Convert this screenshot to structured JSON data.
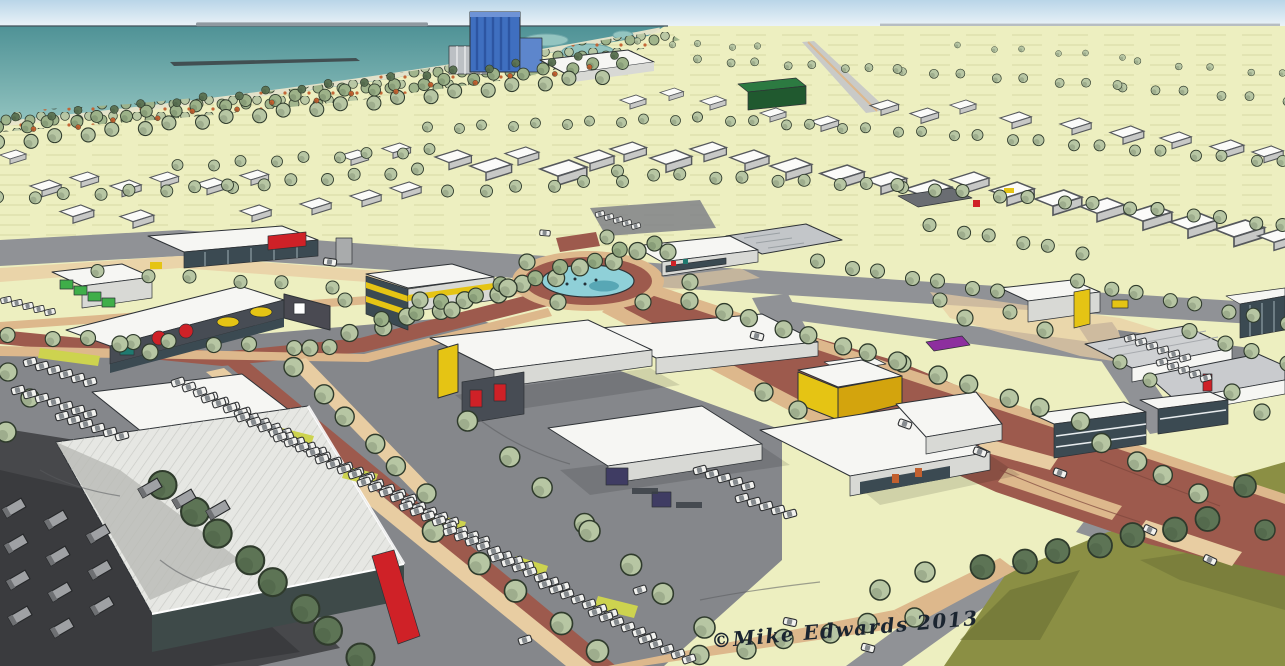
{
  "image": {
    "alt": "Hand-drawn aerial perspective illustration of a coastal retail and business park, with sea and a blue harbour tower at top left, tree-lined fields behind, white retail sheds with coloured shop signs, tree-lined avenues, car parks full of white cars, a pond roundabout, and an olive green hill at bottom right."
  },
  "signature": {
    "text": "©Mike Edwards 2013"
  },
  "palette": {
    "sky-top": "#b9d5e8",
    "sky-bottom": "#eef5f9",
    "sea-deep": "#4f9296",
    "sea-light": "#93c4c0",
    "beach": "#e9e5cb",
    "field": "#edefc0",
    "field-line": "#d7daa5",
    "tree-light": "#b7c6a3",
    "tree-mid": "#9db289",
    "tree-dark": "#5d7455",
    "tree-line": "#2f3b2c",
    "shrub-orange": "#c2602f",
    "road": "#909296",
    "road-dark": "#6f7175",
    "lot": "#85878b",
    "yard-dark": "#47484b",
    "yard-shadow": "#3a3b3e",
    "tan": "#ddb88c",
    "tan-light": "#e8cda2",
    "plaza-red": "#9d5a4d",
    "pond": "#8fd0d8",
    "pond-deep": "#58a7b5",
    "olive": "#8b8f44",
    "olive-dark": "#6b7034",
    "bldg-white": "#f6f6f3",
    "bldg-shade": "#d8d9d5",
    "bldg-side": "#a9abac",
    "glaze": "#3b4a52",
    "ink": "#2e3236",
    "fascia-dark": "#474c54",
    "sign-red": "#cf2127",
    "sign-yellow": "#e5c414",
    "sign-green": "#3fae49",
    "sign-teal": "#1f7a70",
    "sign-purple": "#8d2f9e",
    "sign-navy": "#3f3c63",
    "tower-blue": "#3f6fc0",
    "tower-blue-dark": "#2d55a2",
    "silo": "#bcc0c4",
    "green-box": "#20592f",
    "verge": "#cdd34f",
    "car-body": "#f2f2ef",
    "roof-rib": "#c6c7c3",
    "warehouse-teal": "#3e4a49"
  },
  "scene": {
    "tree_rows": [
      [
        0,
        128,
        620,
        62,
        26,
        6,
        "tree-mid"
      ],
      [
        0,
        143,
        600,
        76,
        22,
        7,
        "tree-light"
      ],
      [
        18,
        118,
        612,
        54,
        20,
        4,
        "tree-dark"
      ],
      [
        36,
        130,
        592,
        68,
        15,
        2.6,
        "shrub-orange"
      ],
      [
        430,
        128,
        700,
        118,
        11,
        5,
        "tree-light"
      ],
      [
        700,
        118,
        980,
        136,
        11,
        5,
        "tree-light"
      ],
      [
        980,
        136,
        1285,
        162,
        11,
        5.5,
        "tree-light"
      ],
      [
        180,
        166,
        432,
        150,
        9,
        5.5,
        "tree-light"
      ],
      [
        0,
        198,
        230,
        186,
        8,
        6,
        "tree-light"
      ],
      [
        230,
        186,
        420,
        170,
        7,
        6,
        "tree-light"
      ],
      [
        620,
        172,
        900,
        186,
        10,
        6,
        "tree-light"
      ],
      [
        900,
        186,
        1160,
        210,
        9,
        6.5,
        "tree-light"
      ],
      [
        1160,
        210,
        1285,
        226,
        5,
        6.5,
        "tree-light"
      ],
      [
        450,
        192,
        620,
        180,
        6,
        6,
        "tree-light"
      ],
      [
        700,
        60,
        900,
        70,
        8,
        4,
        "tree-light"
      ],
      [
        900,
        70,
        1120,
        86,
        8,
        4.5,
        "tree-light"
      ],
      [
        1120,
        86,
        1285,
        100,
        6,
        4.5,
        "tree-light"
      ],
      [
        640,
        42,
        760,
        47,
        5,
        3.2,
        "tree-light"
      ],
      [
        960,
        46,
        1120,
        56,
        6,
        3,
        "tree-light"
      ],
      [
        1140,
        62,
        1285,
        74,
        5,
        3.4,
        "tree-light"
      ],
      [
        352,
        334,
        640,
        252,
        11,
        8.5,
        "tree-light"
      ],
      [
        384,
        320,
        652,
        242,
        10,
        7.5,
        "tree-mid"
      ],
      [
        10,
        336,
        332,
        348,
        9,
        7.5,
        "tree-light"
      ],
      [
        692,
        302,
        900,
        362,
        8,
        8.5,
        "tree-light"
      ],
      [
        900,
        362,
        1078,
        420,
        6,
        9,
        "tree-light"
      ],
      [
        820,
        262,
        1000,
        292,
        7,
        7,
        "tree-light"
      ],
      [
        1080,
        282,
        1285,
        322,
        8,
        7,
        "tree-light"
      ],
      [
        1192,
        332,
        1285,
        362,
        4,
        7.5,
        "tree-light"
      ],
      [
        932,
        226,
        1080,
        252,
        6,
        6.5,
        "tree-light"
      ],
      [
        296,
        368,
        424,
        492,
        6,
        9.5,
        "tree-light"
      ],
      [
        470,
        422,
        582,
        522,
        4,
        10,
        "tree-light"
      ],
      [
        592,
        532,
        702,
        626,
        4,
        10.5,
        "tree-light"
      ],
      [
        702,
        656,
        912,
        616,
        6,
        9.5,
        "tree-light"
      ],
      [
        985,
        568,
        1210,
        520,
        7,
        12,
        "tree-dark"
      ],
      [
        165,
        486,
        358,
        656,
        8,
        14,
        "tree-dark"
      ],
      [
        100,
        272,
        330,
        286,
        6,
        6.5,
        "tree-light"
      ],
      [
        436,
        532,
        600,
        652,
        5,
        11,
        "tree-light"
      ],
      [
        1104,
        444,
        1196,
        492,
        4,
        9.5,
        "tree-light"
      ]
    ],
    "trees": [
      [
        527,
        262,
        8
      ],
      [
        558,
        302,
        8
      ],
      [
        643,
        302,
        8
      ],
      [
        668,
        252,
        8
      ],
      [
        607,
        237,
        7
      ],
      [
        508,
        288,
        9
      ],
      [
        690,
        282,
        8
      ],
      [
        8,
        372,
        9
      ],
      [
        30,
        398,
        9
      ],
      [
        6,
        432,
        10
      ],
      [
        150,
        352,
        8
      ],
      [
        120,
        344,
        8
      ],
      [
        1045,
        330,
        8
      ],
      [
        1010,
        312,
        7
      ],
      [
        965,
        318,
        8
      ],
      [
        940,
        300,
        7
      ],
      [
        1232,
        392,
        8
      ],
      [
        1262,
        412,
        8
      ],
      [
        1245,
        486,
        11,
        "tree-dark"
      ],
      [
        1265,
        530,
        10,
        "tree-dark"
      ],
      [
        880,
        590,
        10
      ],
      [
        925,
        572,
        10
      ],
      [
        420,
        300,
        8
      ],
      [
        452,
        310,
        8
      ],
      [
        764,
        392,
        9
      ],
      [
        798,
        410,
        9
      ],
      [
        1120,
        362,
        7
      ],
      [
        1150,
        380,
        7
      ],
      [
        345,
        300,
        7
      ],
      [
        310,
        348,
        8
      ]
    ],
    "car_rows": [
      [
        178,
        382,
        11,
        5,
        7,
        -18
      ],
      [
        208,
        398,
        11,
        5,
        8,
        -18
      ],
      [
        243,
        417,
        11,
        5,
        8,
        -18
      ],
      [
        280,
        437,
        11,
        5,
        9,
        -18
      ],
      [
        322,
        459,
        11,
        5,
        9,
        -18
      ],
      [
        364,
        482,
        11,
        5,
        9,
        -18
      ],
      [
        406,
        506,
        11,
        5,
        8,
        -18
      ],
      [
        450,
        531,
        11,
        5,
        8,
        -18
      ],
      [
        497,
        557,
        11,
        5,
        7,
        -18
      ],
      [
        545,
        584,
        11,
        5,
        7,
        -18
      ],
      [
        595,
        612,
        11,
        5,
        6,
        -18
      ],
      [
        645,
        639,
        11,
        5,
        5,
        -18
      ],
      [
        30,
        362,
        12,
        4,
        6,
        -15
      ],
      [
        18,
        390,
        12,
        4,
        7,
        -15
      ],
      [
        62,
        416,
        12,
        4,
        6,
        -15
      ],
      [
        700,
        470,
        12,
        4,
        5,
        -15
      ],
      [
        742,
        498,
        12,
        4,
        5,
        -15
      ],
      [
        600,
        214,
        9,
        3,
        5,
        -15,
        0.7
      ],
      [
        1130,
        338,
        11,
        4,
        6,
        -15,
        0.85
      ],
      [
        1162,
        362,
        11,
        4,
        5,
        -15,
        0.85
      ],
      [
        6,
        300,
        11,
        3,
        5,
        -12,
        0.8
      ]
    ],
    "cars": [
      [
        757,
        336,
        15
      ],
      [
        905,
        424,
        20
      ],
      [
        1060,
        473,
        20
      ],
      [
        1150,
        530,
        25
      ],
      [
        980,
        452,
        20
      ],
      [
        640,
        590,
        -18
      ],
      [
        790,
        622,
        12
      ],
      [
        525,
        640,
        -18
      ],
      [
        330,
        262,
        8
      ],
      [
        545,
        233,
        5,
        0.8
      ],
      [
        1210,
        560,
        25
      ],
      [
        868,
        648,
        15
      ]
    ],
    "trailer_rows": [
      [
        14,
        508,
        2,
        36,
        4,
        -30
      ],
      [
        56,
        520,
        2,
        36,
        4,
        -30
      ],
      [
        98,
        534,
        2,
        36,
        3,
        -30
      ],
      [
        150,
        488,
        34,
        11,
        3,
        -30
      ]
    ],
    "sheds": [
      [
        435,
        150,
        1.4
      ],
      [
        470,
        158,
        1.6
      ],
      [
        505,
        147,
        1.3
      ],
      [
        540,
        160,
        1.8
      ],
      [
        575,
        150,
        1.5
      ],
      [
        610,
        142,
        1.4
      ],
      [
        650,
        150,
        1.6
      ],
      [
        690,
        142,
        1.4
      ],
      [
        730,
        150,
        1.5
      ],
      [
        770,
        158,
        1.6
      ],
      [
        820,
        165,
        1.7
      ],
      [
        865,
        172,
        1.6
      ],
      [
        905,
        180,
        1.8
      ],
      [
        950,
        172,
        1.5
      ],
      [
        990,
        182,
        1.7
      ],
      [
        1035,
        190,
        1.8
      ],
      [
        1080,
        198,
        1.7
      ],
      [
        1125,
        205,
        1.8
      ],
      [
        1170,
        213,
        1.8
      ],
      [
        1215,
        220,
        1.9
      ],
      [
        1258,
        228,
        1.6
      ],
      [
        620,
        95,
        1.0
      ],
      [
        660,
        88,
        0.9
      ],
      [
        700,
        96,
        1.0
      ],
      [
        760,
        108,
        1.0
      ],
      [
        810,
        116,
        1.1
      ],
      [
        870,
        100,
        1.1
      ],
      [
        910,
        108,
        1.1
      ],
      [
        950,
        100,
        1.0
      ],
      [
        1000,
        112,
        1.2
      ],
      [
        1060,
        118,
        1.2
      ],
      [
        1110,
        126,
        1.3
      ],
      [
        1160,
        132,
        1.2
      ],
      [
        1210,
        140,
        1.3
      ],
      [
        1252,
        146,
        1.2
      ],
      [
        30,
        180,
        1.2
      ],
      [
        70,
        172,
        1.1
      ],
      [
        110,
        180,
        1.2
      ],
      [
        150,
        172,
        1.1
      ],
      [
        195,
        178,
        1.2
      ],
      [
        240,
        170,
        1.1
      ],
      [
        60,
        205,
        1.3
      ],
      [
        120,
        210,
        1.3
      ],
      [
        240,
        205,
        1.2
      ],
      [
        300,
        198,
        1.2
      ],
      [
        350,
        190,
        1.2
      ],
      [
        390,
        182,
        1.2
      ],
      [
        0,
        150,
        1.0
      ],
      [
        340,
        150,
        1.1
      ],
      [
        382,
        143,
        1.1
      ]
    ]
  }
}
